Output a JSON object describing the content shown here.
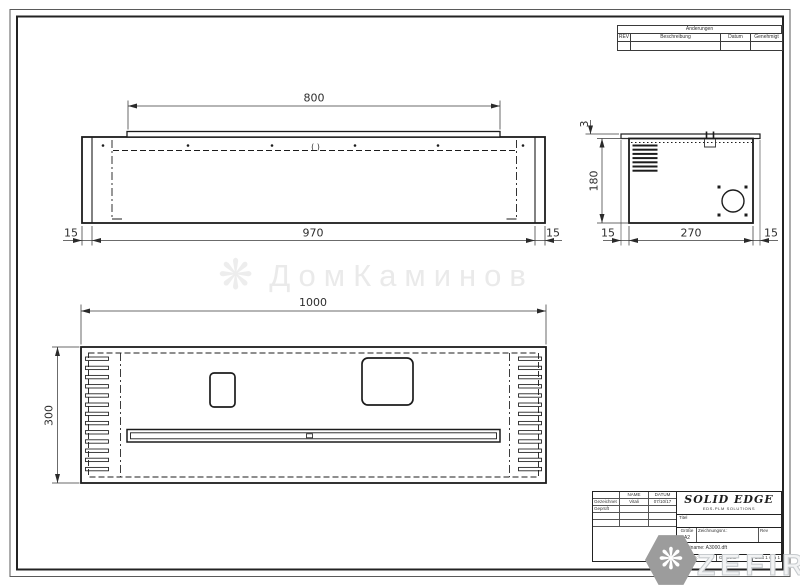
{
  "revision_table": {
    "title": "Änderungen",
    "col_rev": "REV",
    "col_desc": "Beschreibung",
    "col_date": "Datum",
    "col_approved": "Genehmigt"
  },
  "title_block": {
    "col_name": "NAME",
    "col_date": "DATUM",
    "row_drawn_label": "Gezeichnet",
    "row_drawn_name": "Vitali",
    "row_drawn_date": "07/10/17",
    "row_checked_label": "Geprüft",
    "logo_title": "SOLID EDGE",
    "logo_subtitle": "EDS-PLM SOLUTIONS",
    "title_label": "Titel",
    "size_label": "Größe",
    "size_value": "A2",
    "drawing_no_label": "Zeichnungsnr.:",
    "rev_label": "Rev",
    "filename": "Dateiname: A3000.dft",
    "scale_label": "Maßstab:",
    "weight_label": "Gewicht:",
    "sheet_label": "Blatt 1 von 1"
  },
  "views": {
    "front": {
      "dim_top": "800",
      "dim_bottom": "970",
      "dim_left": "15",
      "dim_right": "15",
      "center_mark": "( )"
    },
    "side": {
      "dim_height": "180",
      "dim_plate": "3",
      "dim_bottom": "270",
      "dim_left": "15",
      "dim_right": "15"
    },
    "plan": {
      "dim_width": "1000",
      "dim_depth": "300"
    }
  },
  "watermarks": {
    "center": "ДомКаминов",
    "center_logo_icon": "❋",
    "corner": "ZEFIRE",
    "corner_logo_icon": "❋"
  }
}
